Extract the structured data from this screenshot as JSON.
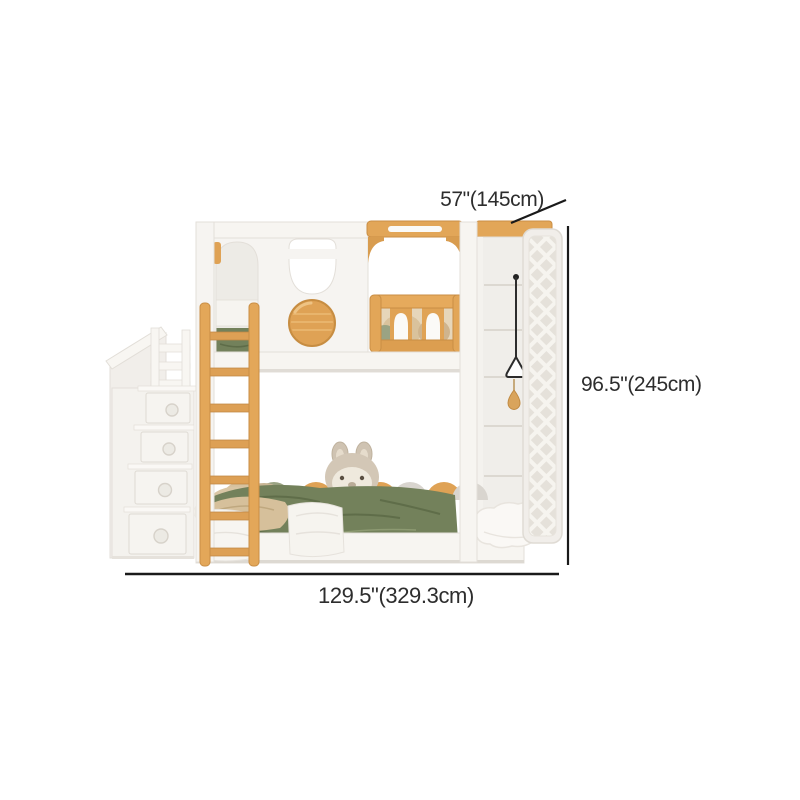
{
  "scene": {
    "description": "White and natural-wood kids bunk bed with storage staircase, leaning ladder, porthole headboard, guard rail, climbing net and landing cushion, shown with dimension lines"
  },
  "dimensions": {
    "depth_label": "57\"(145cm)",
    "height_label": "96.5\"(245cm)",
    "width_label": "129.5\"(329.3cm)"
  },
  "colors": {
    "background": "#ffffff",
    "dimension_line": "#1a1a1a",
    "label_text": "#2d2d2d",
    "frame_white": "#f6f4f1",
    "frame_edge": "#e3dfd9",
    "wood_accent": "#e0a355",
    "wood_dark": "#c98e45",
    "bedding_green": "#73815b",
    "pillow_beige": "#d9c29c",
    "plush_taupe": "#d3c7b6",
    "net_background": "#e5e1da"
  }
}
